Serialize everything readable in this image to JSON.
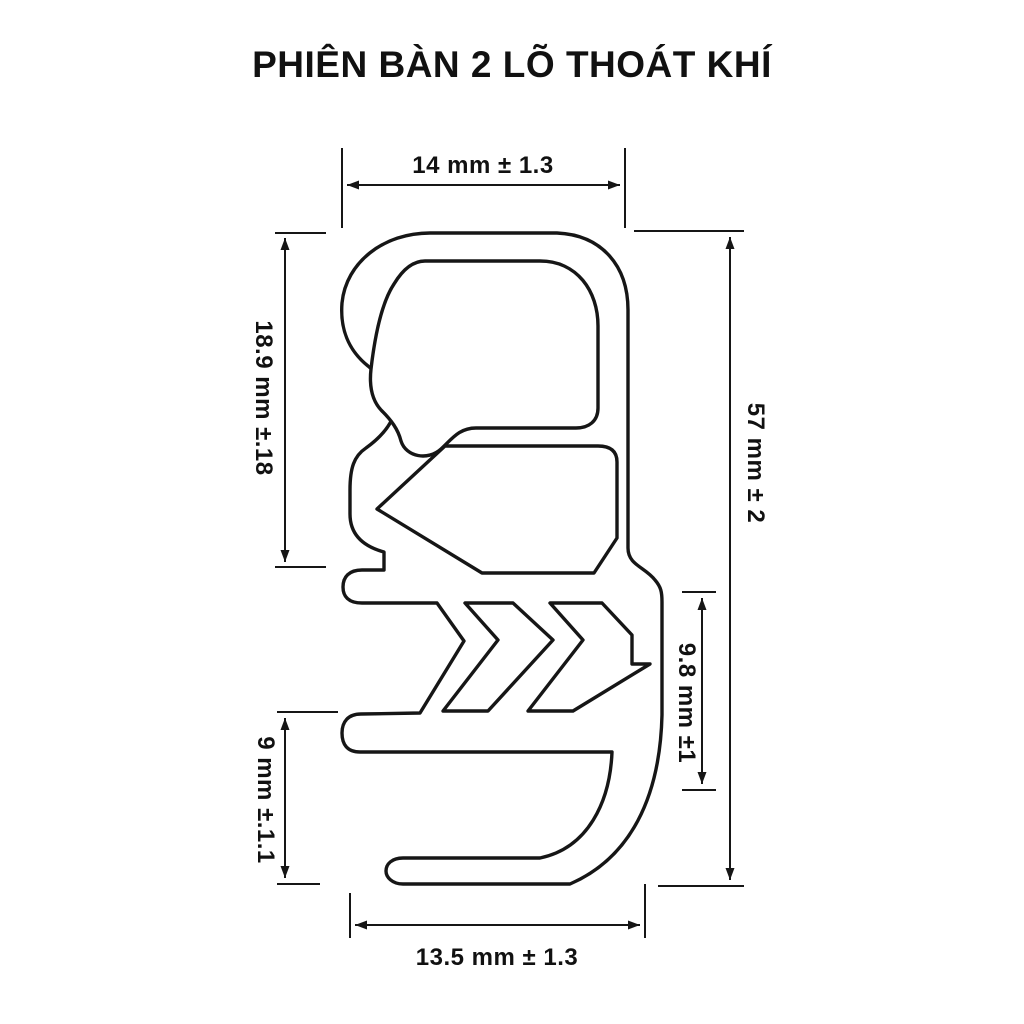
{
  "title": "PHIÊN BÀN 2 LÕ THOÁT KHÍ",
  "drawing": {
    "description": "Cross-section outline of a door gasket profile, version with 2 air vent holes",
    "colors": {
      "line": "#161616",
      "background": "#ffffff"
    },
    "dims": {
      "top": {
        "label": "14 mm ± 1.3",
        "orientation": "horizontal"
      },
      "left_upper": {
        "label": "18.9 mm ±.18",
        "orientation": "vertical"
      },
      "right_overall": {
        "label": "57 mm ± 2",
        "orientation": "vertical"
      },
      "right_inner": {
        "label": "9.8 mm ±1",
        "orientation": "vertical"
      },
      "left_lower": {
        "label": "9 mm ±.1.1",
        "orientation": "vertical"
      },
      "bottom": {
        "label": "13.5 mm ± 1.3",
        "orientation": "horizontal"
      }
    }
  }
}
